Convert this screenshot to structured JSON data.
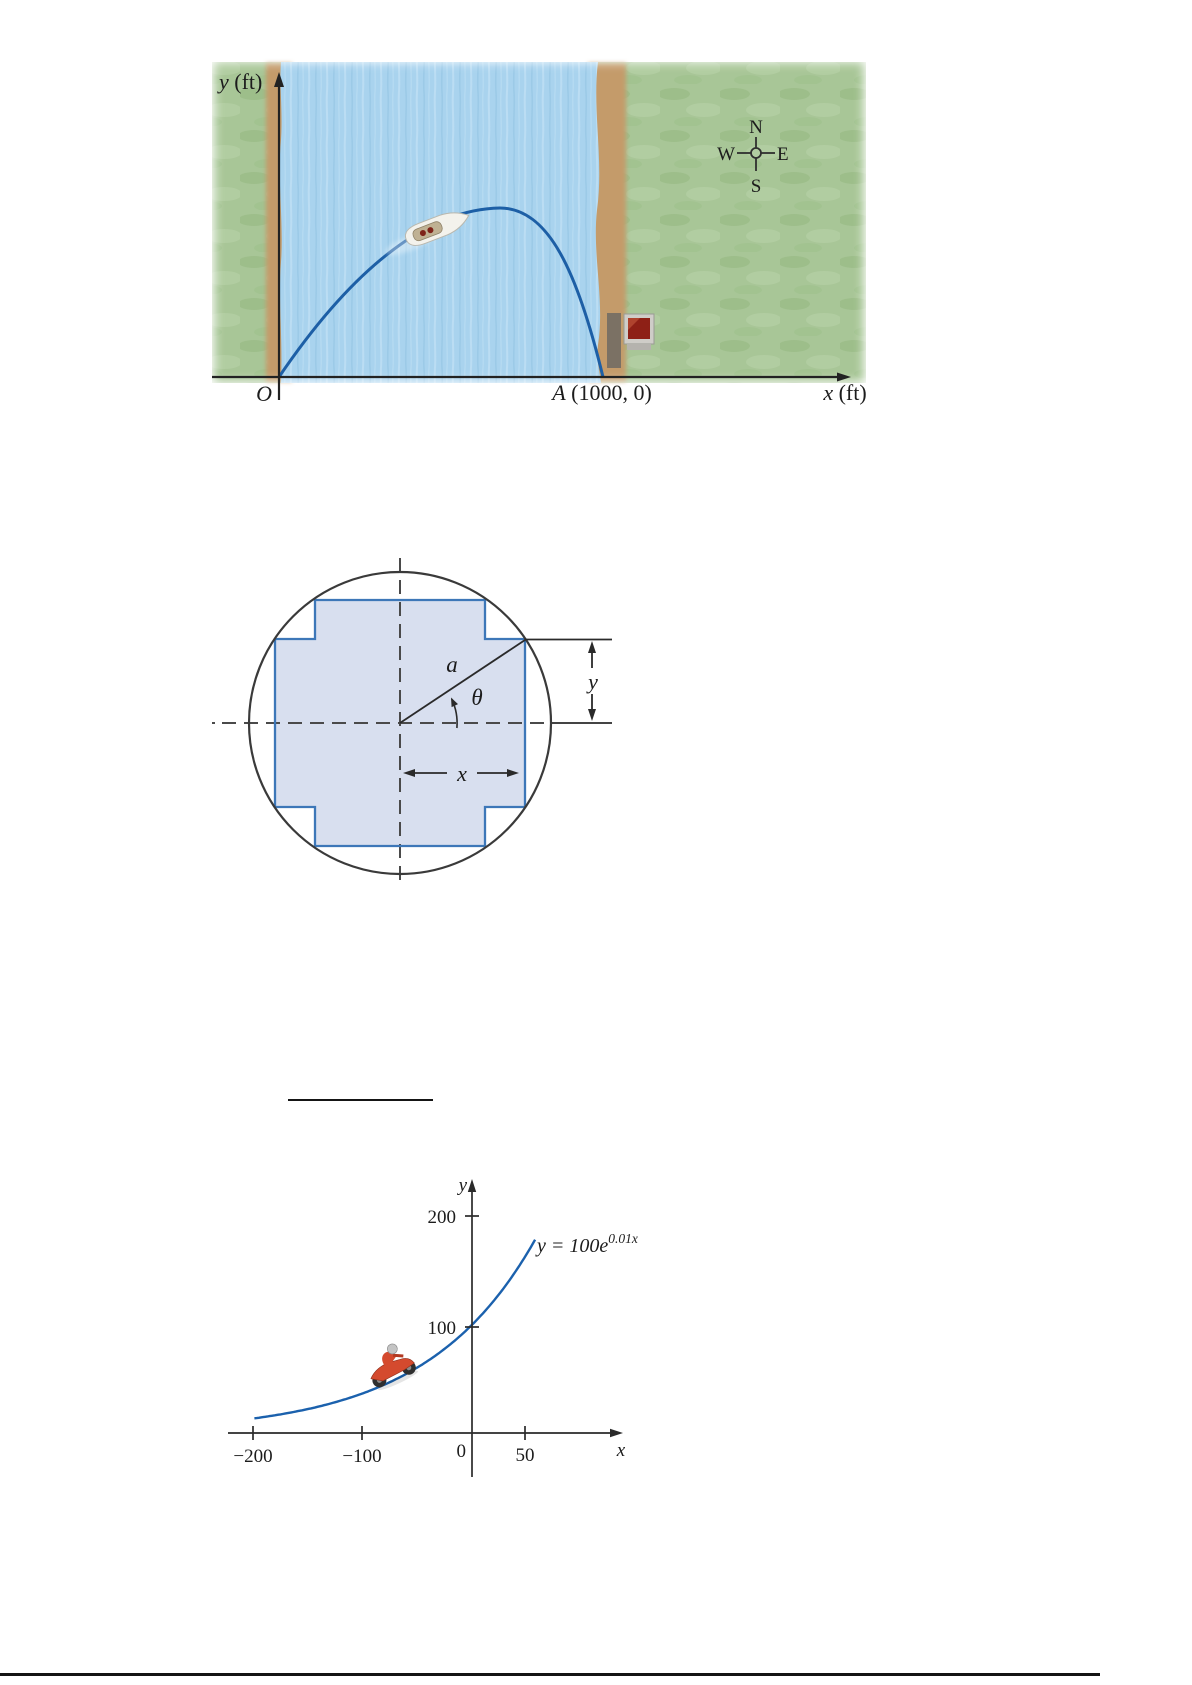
{
  "page": {
    "background": "#ffffff",
    "bottom_rule_color": "#141414"
  },
  "figure_river": {
    "y_axis_var": "y",
    "y_axis_unit": " (ft)",
    "x_axis_var": "x",
    "x_axis_unit": " (ft)",
    "origin_label": "O",
    "point_a_var": "A",
    "point_a_coords": " (1000, 0)",
    "compass": {
      "north": "N",
      "east": "E",
      "south": "S",
      "west": "W"
    },
    "colors": {
      "water": "#a9d3ee",
      "grass": "#a8c697",
      "shore": "#c49b6b",
      "boat_path": "#1d5fa6",
      "axis": "#222222",
      "sign_red": "#8e2016",
      "sign_frame": "#cfcdc8",
      "post": "#7b7164"
    }
  },
  "figure_cross_section": {
    "radius_label": "a",
    "angle_label": "θ",
    "dim_x_label": "x",
    "dim_y_label": "y",
    "colors": {
      "circle_outline": "#3a3a3a",
      "cross_fill": "#d8dfef",
      "cross_stroke": "#3d77b8",
      "dashed_line": "#4a4a4a",
      "dimension_label": "#3a6cb4",
      "radius_line": "#2a2a2a"
    }
  },
  "chart_data": {
    "type": "line",
    "equation": "y = 100e^(0.01x)",
    "annotation": {
      "base": "y = 100e",
      "exp": "0.01x"
    },
    "function": {
      "form": "exponential",
      "coefficient": 100,
      "rate": 0.01
    },
    "x_drawn_range": [
      -200,
      58
    ],
    "x_ticks": [
      {
        "value": -200,
        "label": "−200"
      },
      {
        "value": -100,
        "label": "−100"
      },
      {
        "value": 50,
        "label": "50"
      }
    ],
    "y_ticks": [
      {
        "value": 100,
        "label": "100"
      },
      {
        "value": 200,
        "label": "200"
      }
    ],
    "origin_label": "0",
    "xlabel": "x",
    "ylabel": "y",
    "sample_points": [
      {
        "x": -200,
        "y": 13.5
      },
      {
        "x": -100,
        "y": 36.8
      },
      {
        "x": 0,
        "y": 100
      },
      {
        "x": 50,
        "y": 164.9
      }
    ],
    "curve_color": "#1b61ad",
    "axis_color": "#2a2a2a",
    "grid": false,
    "legend": false
  }
}
